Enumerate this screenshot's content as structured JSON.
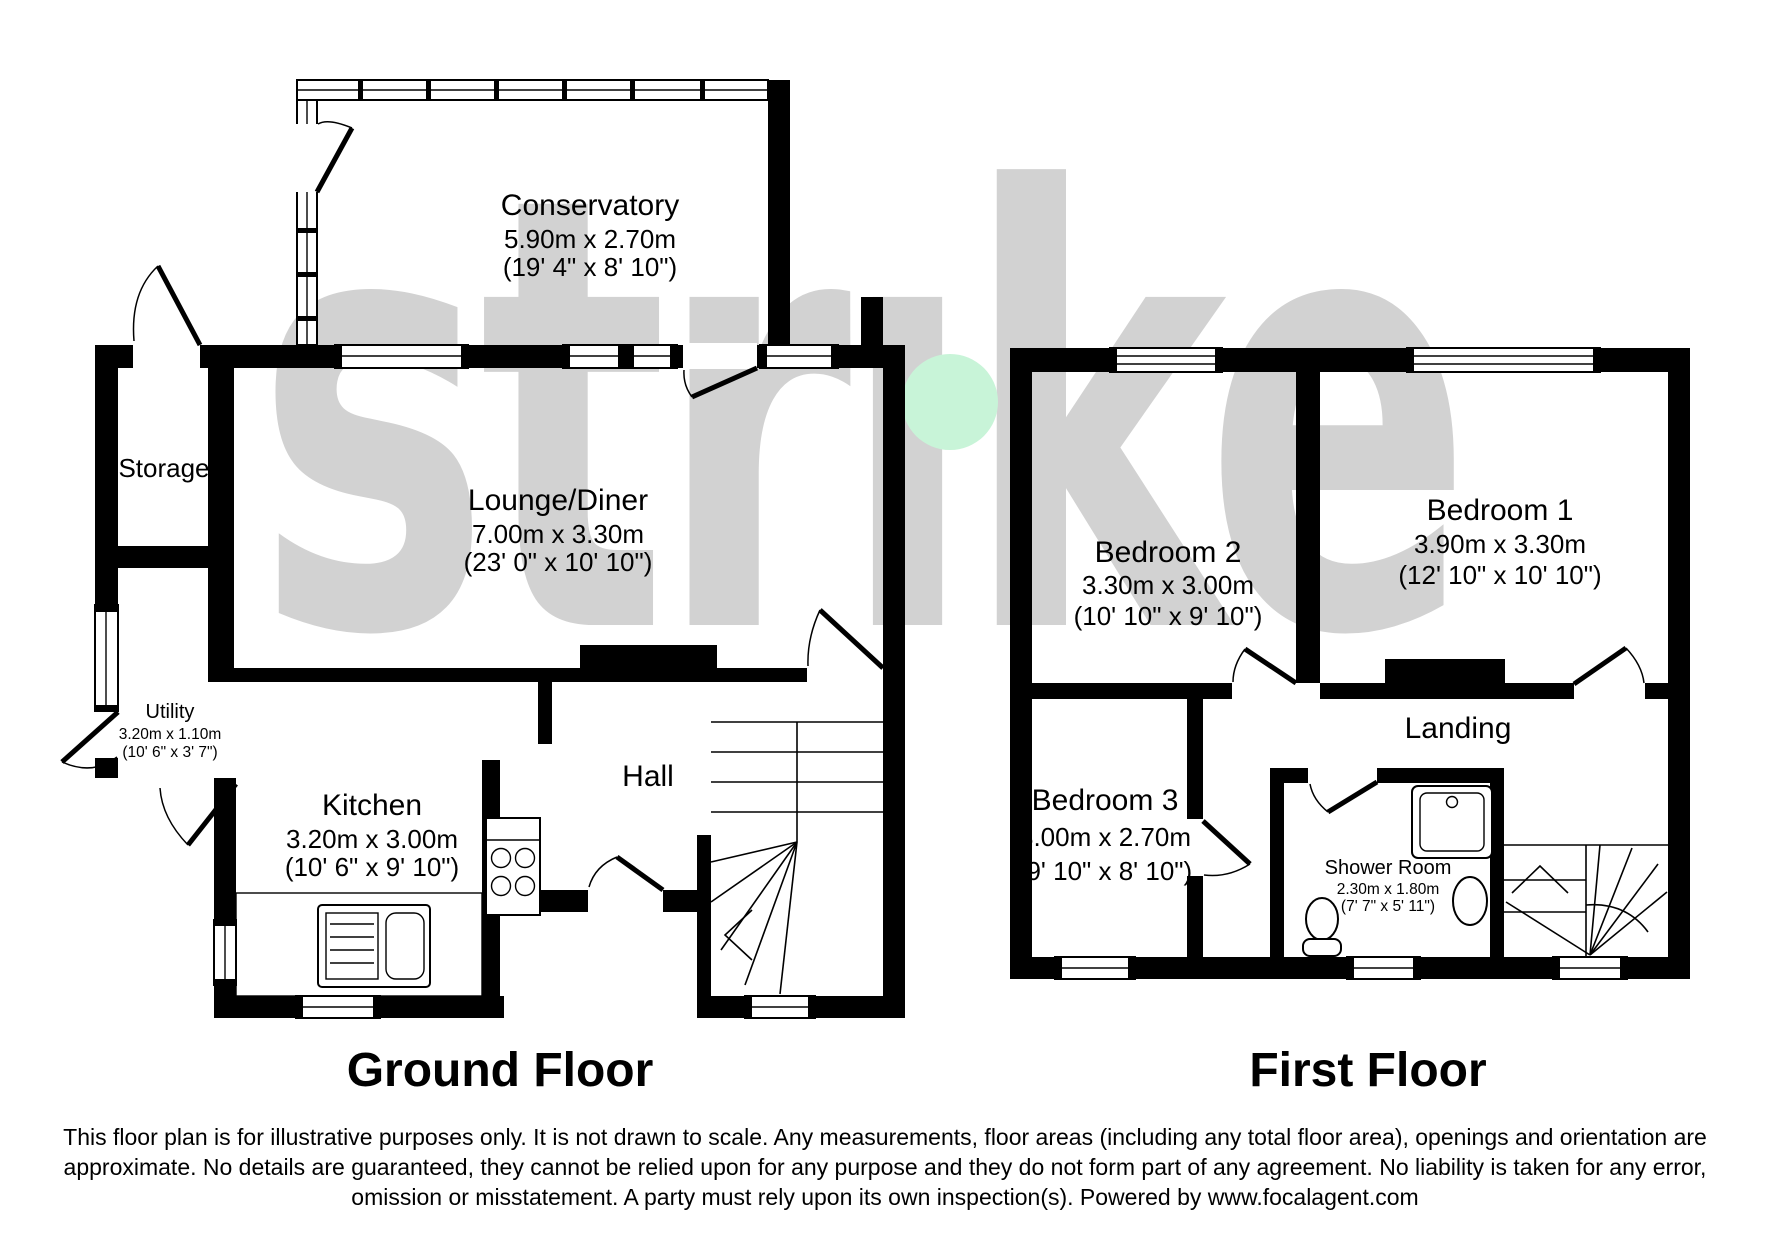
{
  "watermark": {
    "text": "strıke",
    "brand": "strike",
    "color": "#d2d2d2",
    "accent_color": "#c8f4d8"
  },
  "ground_floor": {
    "label": "Ground Floor",
    "rooms": {
      "conservatory": {
        "name": "Conservatory",
        "metric": "5.90m x 2.70m",
        "imperial": "(19' 4\" x 8' 10\")"
      },
      "storage": {
        "name": "Storage"
      },
      "lounge": {
        "name": "Lounge/Diner",
        "metric": "7.00m x 3.30m",
        "imperial": "(23' 0\" x 10' 10\")"
      },
      "utility": {
        "name": "Utility",
        "metric": "3.20m x 1.10m",
        "imperial": "(10' 6\" x 3' 7\")"
      },
      "kitchen": {
        "name": "Kitchen",
        "metric": "3.20m x 3.00m",
        "imperial": "(10' 6\" x 9' 10\")"
      },
      "hall": {
        "name": "Hall"
      }
    }
  },
  "first_floor": {
    "label": "First Floor",
    "rooms": {
      "bedroom2": {
        "name": "Bedroom 2",
        "metric": "3.30m x 3.00m",
        "imperial": "(10' 10\" x 9' 10\")"
      },
      "bedroom1": {
        "name": "Bedroom 1",
        "metric": "3.90m x 3.30m",
        "imperial": "(12' 10\" x 10' 10\")"
      },
      "landing": {
        "name": "Landing"
      },
      "bedroom3": {
        "name": "Bedroom 3",
        "metric": "3.00m x 2.70m",
        "imperial": "(9' 10\" x 8' 10\")"
      },
      "shower": {
        "name": "Shower Room",
        "metric": "2.30m x 1.80m",
        "imperial": "(7' 7\" x 5' 11\")"
      }
    }
  },
  "disclaimer": "This floor plan is for illustrative purposes only. It is not drawn to scale. Any measurements, floor areas (including any total floor area), openings and orientation are approximate. No details are guaranteed, they cannot be relied upon for any purpose and they do not form part of any agreement. No liability is taken for any error, omission or misstatement. A party must rely upon its own inspection(s). Powered by www.focalagent.com"
}
